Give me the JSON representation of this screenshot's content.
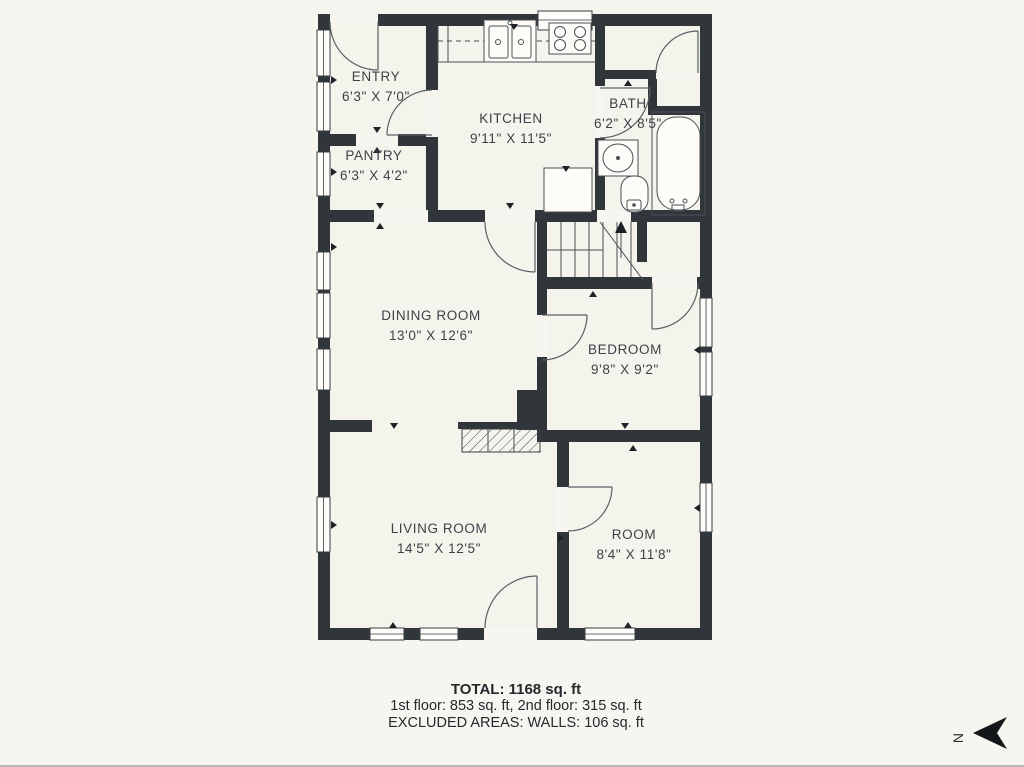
{
  "floor_plan": {
    "rooms": [
      {
        "name": "ENTRY",
        "dims": "6'3\" X 7'0\""
      },
      {
        "name": "KITCHEN",
        "dims": "9'11\" X 11'5\""
      },
      {
        "name": "BATH",
        "dims": "6'2\" X 8'5\""
      },
      {
        "name": "PANTRY",
        "dims": "6'3\" X 4'2\""
      },
      {
        "name": "DINING ROOM",
        "dims": "13'0\" X 12'6\""
      },
      {
        "name": "BEDROOM",
        "dims": "9'8\" X 9'2\""
      },
      {
        "name": "LIVING ROOM",
        "dims": "14'5\" X 12'5\""
      },
      {
        "name": "ROOM",
        "dims": "8'4\" X 11'8\""
      }
    ],
    "summary": {
      "total": "TOTAL: 1168 sq. ft",
      "floors": "1st floor: 853 sq. ft, 2nd floor: 315 sq. ft",
      "excluded": "EXCLUDED AREAS: WALLS: 106 sq. ft"
    },
    "compass": {
      "label": "N"
    },
    "fixtures": [
      "kitchen-sink",
      "stove",
      "refrigerator",
      "bathtub",
      "bath-sink",
      "toilet",
      "staircase",
      "fireplace"
    ],
    "colors": {
      "wall": "#31363b",
      "background": "#f6f5ef",
      "fixture_line": "#5b6065",
      "text": "#3d4248"
    }
  }
}
